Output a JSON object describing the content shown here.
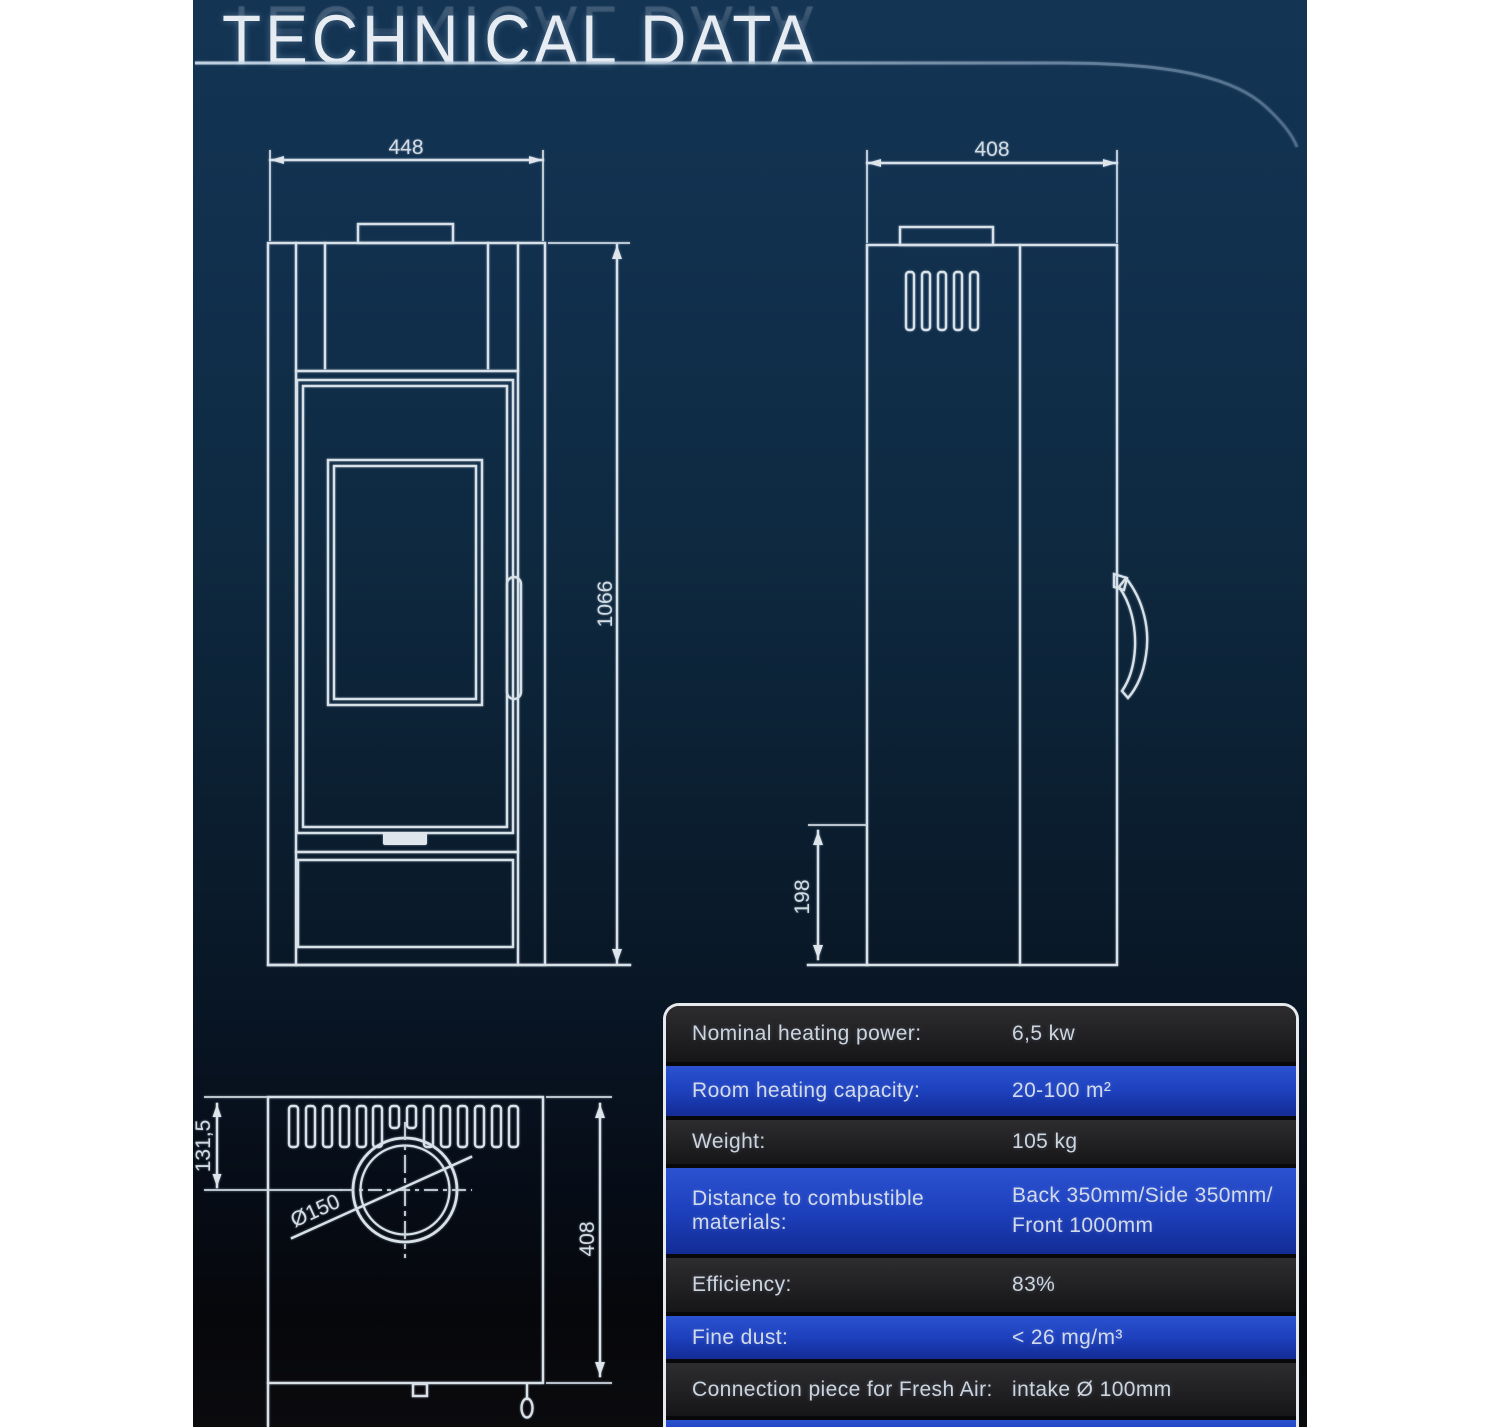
{
  "page": {
    "title": "TECHNICAL DATA"
  },
  "drawings": {
    "front_view": {
      "width_dim": "448",
      "height_dim": "1066"
    },
    "side_view": {
      "width_dim": "408",
      "base_height_dim": "198"
    },
    "top_view": {
      "flue_offset_dim": "131,5",
      "depth_dim": "408",
      "flue_diameter_dim": "Ø150"
    }
  },
  "spec_table": {
    "rows": [
      {
        "label": "Nominal heating power:",
        "value": "6,5 kw"
      },
      {
        "label": "Room heating capacity:",
        "value": "20-100 m²"
      },
      {
        "label": "Weight:",
        "value": "105 kg"
      },
      {
        "label": "Distance to combustible materials:",
        "value": "Back 350mm/Side 350mm/",
        "value_line2": "Front 1000mm"
      },
      {
        "label": "Efficiency:",
        "value": "83%"
      },
      {
        "label": "Fine dust:",
        "value": "< 26 mg/m³"
      },
      {
        "label": "Connection piece for Fresh Air:",
        "value": "intake Ø 100mm"
      },
      {
        "label": "",
        "value": ""
      }
    ]
  },
  "colors": {
    "background_top": "#143454",
    "background_bottom": "#0b0b0e",
    "row_blue": "#1d40bd",
    "row_dark": "#232224",
    "drawing_line": "#d9e1e8",
    "title_text": "#e7edf3"
  }
}
